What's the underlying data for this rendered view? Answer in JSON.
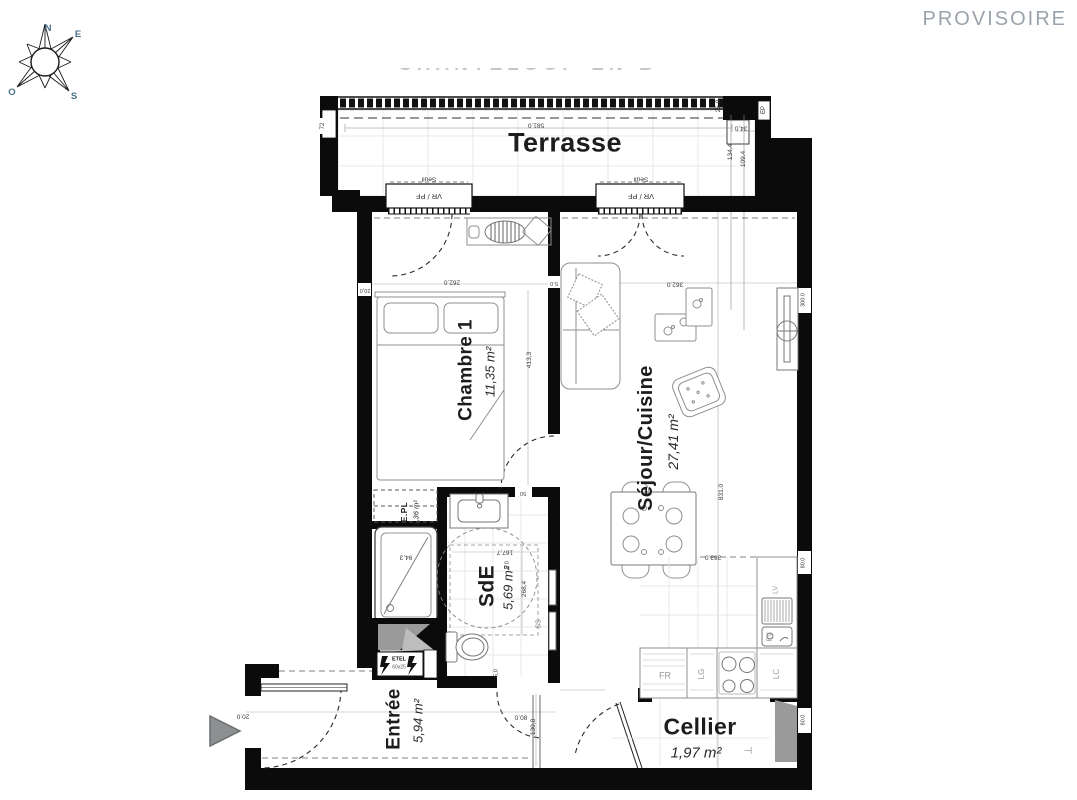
{
  "header": {
    "status": "PROVISOIRE",
    "watermark": "CHANTELOUP-EN-B"
  },
  "compass": {
    "n": "N",
    "e": "E",
    "s": "S",
    "o": "O"
  },
  "colors": {
    "wall": "#0b0b0b",
    "furniture_line": "#8f8f8f",
    "status_text": "#9aa3ac",
    "compass_letters": "#4a7187",
    "dimension_text": "#3c3c3c",
    "shaft_gray": "#9a9a9a"
  },
  "rooms": [
    {
      "name": "Terrasse",
      "area": "",
      "x": 565,
      "y": 143,
      "rot": 0,
      "ns": 27,
      "as": 0,
      "adx": 0,
      "ady": 0
    },
    {
      "name": "Chambre 1",
      "area": "11,35 m²",
      "x": 466,
      "y": 370,
      "rot": -90,
      "ns": 19,
      "as": 13,
      "adx": 24,
      "ady": 2
    },
    {
      "name": "Séjour/Cuisine",
      "area": "27,41 m²",
      "x": 646,
      "y": 438,
      "rot": -90,
      "ns": 20,
      "as": 14,
      "adx": 27,
      "ady": 4
    },
    {
      "name": "SdE",
      "area": "5,69 m²",
      "x": 487,
      "y": 586,
      "rot": -90,
      "ns": 21,
      "as": 13,
      "adx": 21,
      "ady": 2
    },
    {
      "name": "E.PL",
      "area": "1,36 m²",
      "x": 404,
      "y": 512,
      "rot": -90,
      "ns": 8.5,
      "as": 7.5,
      "adx": 12,
      "ady": 1
    },
    {
      "name": "Entrée",
      "area": "5,94 m²",
      "x": 394,
      "y": 719,
      "rot": -90,
      "ns": 19,
      "as": 13,
      "adx": 24,
      "ady": 2
    },
    {
      "name": "Cellier",
      "area": "1,97 m²",
      "x": 700,
      "y": 727,
      "rot": 0,
      "ns": 23,
      "as": 15,
      "adx": -4,
      "ady": 26
    }
  ],
  "labels": [
    {
      "t": "Seuil",
      "x": 429,
      "y": 178,
      "rot": 180,
      "s": 6.5
    },
    {
      "t": "VR / PF",
      "x": 429,
      "y": 196,
      "rot": 180,
      "s": 7.5
    },
    {
      "t": "Seuil",
      "x": 641,
      "y": 178,
      "rot": 180,
      "s": 6.5
    },
    {
      "t": "VR / PF",
      "x": 641,
      "y": 196,
      "rot": 180,
      "s": 7.5
    },
    {
      "t": "EP",
      "x": 764,
      "y": 110,
      "rot": -90,
      "s": 6,
      "c": "#222"
    },
    {
      "t": "FR",
      "x": 665,
      "y": 676,
      "rot": 0,
      "s": 9,
      "c": "#9a9a9a"
    },
    {
      "t": "LG",
      "x": 702,
      "y": 674,
      "rot": -90,
      "s": 8,
      "c": "#9a9a9a"
    },
    {
      "t": "LC",
      "x": 777,
      "y": 674,
      "rot": -90,
      "s": 8,
      "c": "#9a9a9a"
    },
    {
      "t": "LV",
      "x": 776,
      "y": 590,
      "rot": -90,
      "s": 7,
      "c": "#9a9a9a"
    },
    {
      "t": "EV",
      "x": 770,
      "y": 637,
      "rot": -90,
      "s": 7,
      "c": "#9a9a9a"
    },
    {
      "t": "SS",
      "x": 539,
      "y": 624,
      "rot": -90,
      "s": 7,
      "c": "#777"
    },
    {
      "t": "ETEL",
      "x": 399,
      "y": 660,
      "rot": 0,
      "s": 5.5,
      "c": "#111",
      "b": true
    },
    {
      "t": "60x25",
      "x": 399,
      "y": 668,
      "rot": 0,
      "s": 5,
      "c": "#555"
    },
    {
      "t": "⊣",
      "x": 748,
      "y": 752,
      "rot": 0,
      "s": 10,
      "c": "#8f8f8f"
    }
  ],
  "dimensions": [
    {
      "t": "581.0",
      "x": 536,
      "y": 124,
      "rot": 180
    },
    {
      "t": "72",
      "x": 323,
      "y": 126,
      "rot": -90,
      "s": 6
    },
    {
      "t": "34,0",
      "x": 741,
      "y": 127,
      "rot": 180
    },
    {
      "t": "25.0",
      "x": 719,
      "y": 106,
      "rot": -90
    },
    {
      "t": "134,4",
      "x": 731,
      "y": 152,
      "rot": -90
    },
    {
      "t": "109,4",
      "x": 744,
      "y": 159,
      "rot": -90
    },
    {
      "t": "20,0",
      "x": 365,
      "y": 289,
      "rot": 180,
      "s": 5.5
    },
    {
      "t": "262.0",
      "x": 452,
      "y": 281,
      "rot": 180
    },
    {
      "t": "5.0",
      "x": 554,
      "y": 282,
      "rot": 180,
      "s": 5.5
    },
    {
      "t": "362.0",
      "x": 675,
      "y": 283,
      "rot": 180
    },
    {
      "t": "413,3",
      "x": 530,
      "y": 360,
      "rot": -90
    },
    {
      "t": "831.0",
      "x": 722,
      "y": 492,
      "rot": -90
    },
    {
      "t": "300.0",
      "x": 804,
      "y": 300,
      "rot": -90,
      "s": 5.5
    },
    {
      "t": "363.0",
      "x": 713,
      "y": 556,
      "rot": 180
    },
    {
      "t": "50",
      "x": 523,
      "y": 492,
      "rot": 180,
      "s": 5.5
    },
    {
      "t": "167,7",
      "x": 505,
      "y": 551,
      "rot": 180
    },
    {
      "t": "268,4",
      "x": 525,
      "y": 589,
      "rot": -90
    },
    {
      "t": "94,3",
      "x": 406,
      "y": 556,
      "rot": 180
    },
    {
      "t": "5.0",
      "x": 508,
      "y": 565,
      "rot": -90,
      "s": 5.5
    },
    {
      "t": "5,0",
      "x": 497,
      "y": 673,
      "rot": -90,
      "s": 5.5
    },
    {
      "t": "80.0",
      "x": 804,
      "y": 563,
      "rot": -90,
      "s": 5.5
    },
    {
      "t": "20.0",
      "x": 243,
      "y": 715,
      "rot": 180
    },
    {
      "t": "80.0",
      "x": 521,
      "y": 716,
      "rot": 180
    },
    {
      "t": "130,8",
      "x": 534,
      "y": 727,
      "rot": -90
    },
    {
      "t": "80.0",
      "x": 804,
      "y": 720,
      "rot": -90,
      "s": 5.5
    }
  ]
}
